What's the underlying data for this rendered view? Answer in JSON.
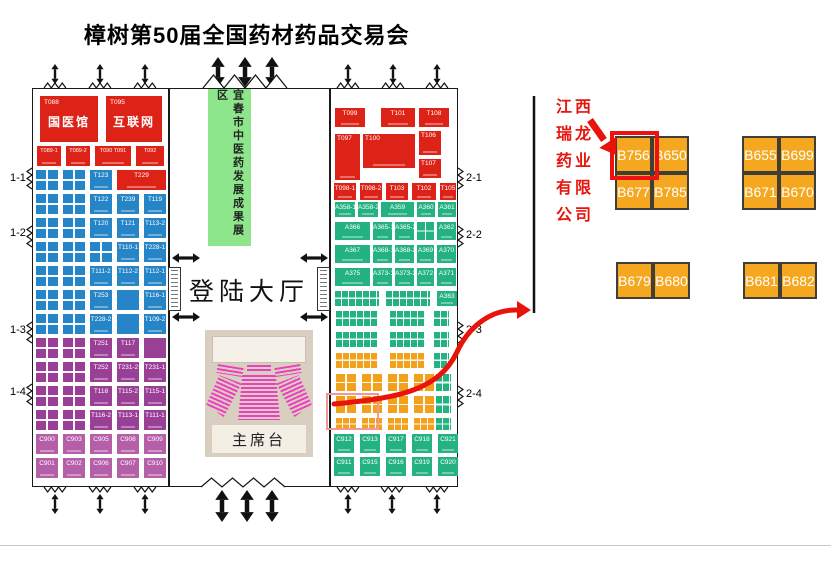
{
  "title": "樟树第50届全国药材药品交易会",
  "colors": {
    "booth_red": "#dd2318",
    "booth_blue": "#2585c6",
    "booth_purple": "#993f96",
    "booth_magenta": "#b55fa8",
    "booth_green": "#25b283",
    "booth_orange": "#f2a11d",
    "detail_booth_orange": "#f5a81f",
    "zone_green": "#8de68c",
    "annotation_red": "#e8150c",
    "highlight_red": "#ee1111"
  },
  "map": {
    "left_hall": {
      "row_labels": [
        "1-1",
        "1-2",
        "1-3",
        "1-4"
      ],
      "featured": [
        {
          "id": "T088",
          "name": "国医馆"
        },
        {
          "id": "T095",
          "name": "互联网"
        }
      ],
      "red_row": [
        "T089-1",
        "T089-2",
        "T090 T091",
        "T092"
      ],
      "rows": [
        {
          "c": "blue",
          "cells": [
            "G",
            "G",
            {
              "l": "T123"
            },
            {
              "l": "T229",
              "c": "red",
              "w": 2
            }
          ]
        },
        {
          "c": "blue",
          "cells": [
            "G",
            "G",
            {
              "l": "T122"
            },
            {
              "l": "T239"
            },
            {
              "l": "T119"
            }
          ]
        },
        {
          "c": "blue",
          "cells": [
            "G",
            "G",
            {
              "l": "T120"
            },
            {
              "l": "T121"
            },
            {
              "l": "T113-2"
            }
          ]
        },
        {
          "c": "blue",
          "cells": [
            "G",
            "G",
            "G",
            {
              "l": "T110-1"
            },
            {
              "l": "T228-1"
            }
          ]
        },
        {
          "c": "blue",
          "cells": [
            "G",
            "G",
            {
              "l": "T111-2"
            },
            {
              "l": "T112-2"
            },
            {
              "l": "T112-1"
            }
          ]
        },
        {
          "c": "blue",
          "cells": [
            "G",
            "G",
            {
              "l": "T253"
            },
            {
              "l": ""
            },
            {
              "l": "T116-1"
            }
          ]
        },
        {
          "c": "blue",
          "cells": [
            "G",
            "G",
            {
              "l": "T228-2"
            },
            {
              "l": ""
            },
            {
              "l": "T109-2"
            }
          ]
        },
        {
          "c": "purple",
          "cells": [
            "G",
            "G",
            {
              "l": "T251"
            },
            {
              "l": "T117"
            },
            {
              "l": ""
            }
          ]
        },
        {
          "c": "purple",
          "cells": [
            "G",
            "G",
            {
              "l": "T252"
            },
            {
              "l": "T231-2"
            },
            {
              "l": "T231-1"
            }
          ]
        },
        {
          "c": "purple",
          "cells": [
            "G",
            "G",
            {
              "l": "T118"
            },
            {
              "l": "T115-2"
            },
            {
              "l": "T115-1"
            }
          ]
        },
        {
          "c": "purple",
          "cells": [
            "G",
            "G",
            {
              "l": "T116-2"
            },
            {
              "l": "T113-1"
            },
            {
              "l": "T111-1"
            }
          ]
        },
        {
          "c": "magenta",
          "cells": [
            {
              "l": "C900"
            },
            {
              "l": "C903"
            },
            {
              "l": "C905"
            },
            {
              "l": "C908"
            },
            {
              "l": "C909"
            }
          ]
        },
        {
          "c": "magenta",
          "cells": [
            {
              "l": "C901"
            },
            {
              "l": "C902"
            },
            {
              "l": "C906"
            },
            {
              "l": "C907"
            },
            {
              "l": "C910"
            }
          ]
        }
      ]
    },
    "center_hall": {
      "green_zone_label": "宜春市中医药发展成果展区",
      "hall_label": "登陆大厅",
      "stage_label": "主席台"
    },
    "right_hall": {
      "row_labels": [
        "2-1",
        "2-2",
        "2-3",
        "2-4"
      ],
      "red_large": [
        "T097",
        "T100",
        "T106",
        "T107"
      ],
      "rows": [
        {
          "c": "red",
          "cells": [
            {
              "l": "T099"
            },
            {
              "l": "T101"
            },
            {
              "l": "T108"
            }
          ]
        },
        {
          "c": "red",
          "cells": [
            {
              "l": "T098-1"
            },
            {
              "l": "T098-2"
            },
            {
              "l": "T103"
            },
            {
              "l": "T102"
            },
            {
              "l": "T105"
            }
          ]
        },
        {
          "c": "green",
          "cells": [
            {
              "l": "A358-1"
            },
            {
              "l": "A358-2"
            },
            {
              "l": "A359"
            },
            {
              "l": "A360"
            },
            {
              "l": "A361"
            }
          ]
        },
        {
          "c": "green",
          "cells": [
            {
              "l": "A366"
            },
            {
              "l": "A365-1"
            },
            {
              "l": "A365-2"
            },
            "G",
            {
              "l": "A362"
            }
          ]
        },
        {
          "c": "green",
          "cells": [
            {
              "l": "A367"
            },
            {
              "l": "A368-1"
            },
            {
              "l": "A368-2"
            },
            {
              "l": "A369"
            },
            {
              "l": "A370"
            }
          ]
        },
        {
          "c": "green",
          "cells": [
            {
              "l": "A375"
            },
            {
              "l": "A373-1"
            },
            {
              "l": "A373-2"
            },
            {
              "l": "A372"
            },
            {
              "l": "A371"
            }
          ]
        },
        {
          "c": "green",
          "cells": [
            {
              "s": 5
            },
            {
              "s": 5
            },
            {
              "l": "A363"
            }
          ]
        },
        {
          "c": "green",
          "cells": [
            {
              "s": 6
            },
            {
              "s": 5
            },
            {
              "s": 2
            }
          ]
        },
        {
          "c": "green",
          "cells": [
            {
              "s": 6
            },
            {
              "s": 5
            },
            {
              "s": 2
            }
          ]
        },
        {
          "c": "orange",
          "cells": [
            {
              "s": 6
            },
            {
              "s": 5
            },
            {
              "s": 2,
              "c": "green"
            }
          ]
        },
        {
          "c": "orange",
          "cells": [
            "G",
            "G",
            "G",
            "G",
            {
              "s": 2,
              "c": "green"
            }
          ]
        },
        {
          "c": "orange",
          "cells": [
            "G",
            "G",
            "G",
            "G",
            {
              "s": 2,
              "c": "green"
            }
          ]
        },
        {
          "c": "orange",
          "cells": [
            {
              "s": 2
            },
            {
              "s": 2
            },
            {
              "s": 2
            },
            {
              "s": 2
            },
            {
              "s": 2,
              "c": "green"
            }
          ]
        },
        {
          "c": "green",
          "cells": [
            {
              "l": "C912"
            },
            {
              "l": "C913"
            },
            {
              "l": "C917"
            },
            {
              "l": "C918"
            },
            {
              "l": "C921"
            }
          ]
        },
        {
          "c": "green",
          "cells": [
            {
              "l": "C911"
            },
            {
              "l": "C915"
            },
            {
              "l": "C916"
            },
            {
              "l": "C919"
            },
            {
              "l": "C920"
            }
          ]
        }
      ]
    }
  },
  "annotation": {
    "company": "江西瑞龙药业有限公司",
    "company_lines": [
      "江西",
      "瑞龙",
      "药业",
      "有限",
      "公司"
    ],
    "highlighted_booth": "B756"
  },
  "detail_booths": {
    "group1": [
      [
        "B756",
        "B650"
      ],
      [
        "B677",
        "B785"
      ]
    ],
    "group2": [
      [
        "B655",
        "B699"
      ],
      [
        "B671",
        "B670"
      ]
    ],
    "group3": [
      [
        "B679",
        "B680"
      ]
    ],
    "group4": [
      [
        "B681",
        "B682"
      ]
    ]
  }
}
